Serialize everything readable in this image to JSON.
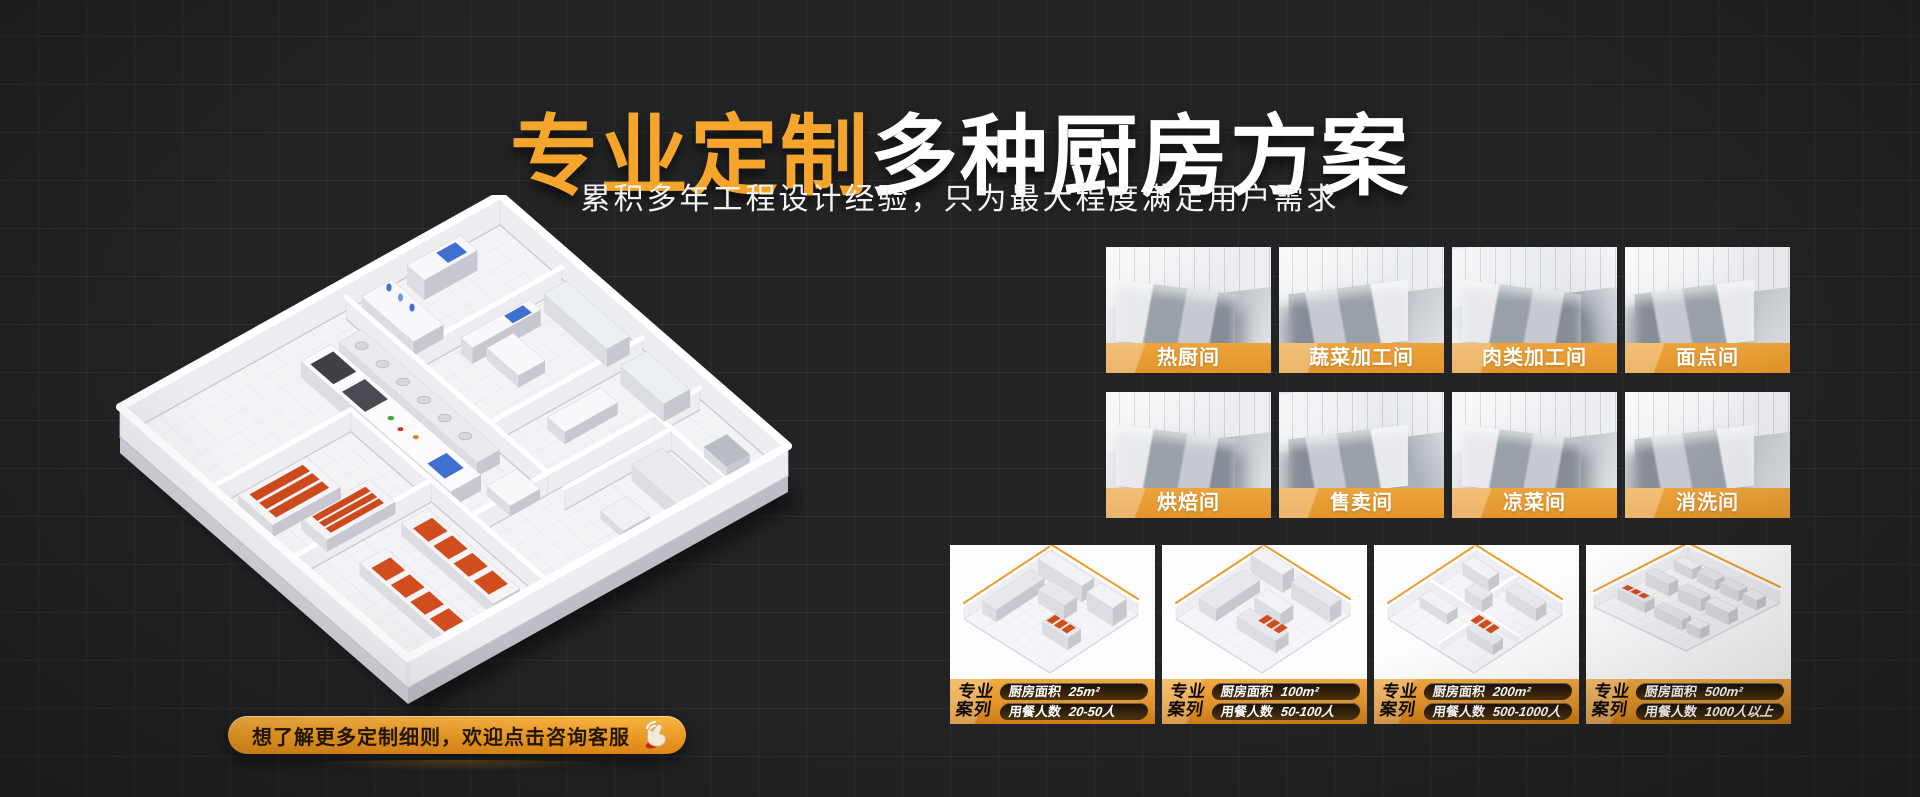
{
  "colors": {
    "accent_orange": "#F5A52B",
    "band_orange": "#E2952A",
    "footer_orange_top": "#F2A93F",
    "background": "#222324"
  },
  "hero": {
    "title_highlight": "专业定制",
    "title_rest": "多种厨房方案",
    "subtitle": "累积多年工程设计经验，只为最大程度满足用户需求"
  },
  "cta": {
    "label": "想了解更多定制细则，欢迎点击咨询客服",
    "icon": "click-hand-icon"
  },
  "rooms": [
    {
      "label": "热厨间"
    },
    {
      "label": "蔬菜加工间"
    },
    {
      "label": "肉类加工间"
    },
    {
      "label": "面点间"
    },
    {
      "label": "烘焙间"
    },
    {
      "label": "售卖间"
    },
    {
      "label": "凉菜间"
    },
    {
      "label": "消洗间"
    }
  ],
  "cases_common": {
    "tag_line1": "专业",
    "tag_line2": "案列",
    "area_label": "厨房面积",
    "diners_label": "用餐人数"
  },
  "cases": [
    {
      "area_value": "25m²",
      "diners_value": "20-50人"
    },
    {
      "area_value": "100m²",
      "diners_value": "50-100人"
    },
    {
      "area_value": "200m²",
      "diners_value": "500-1000人"
    },
    {
      "area_value": "500m²",
      "diners_value": "1000人以上"
    }
  ],
  "floorplan": {
    "alt": "isometric-kitchen-floorplan"
  }
}
